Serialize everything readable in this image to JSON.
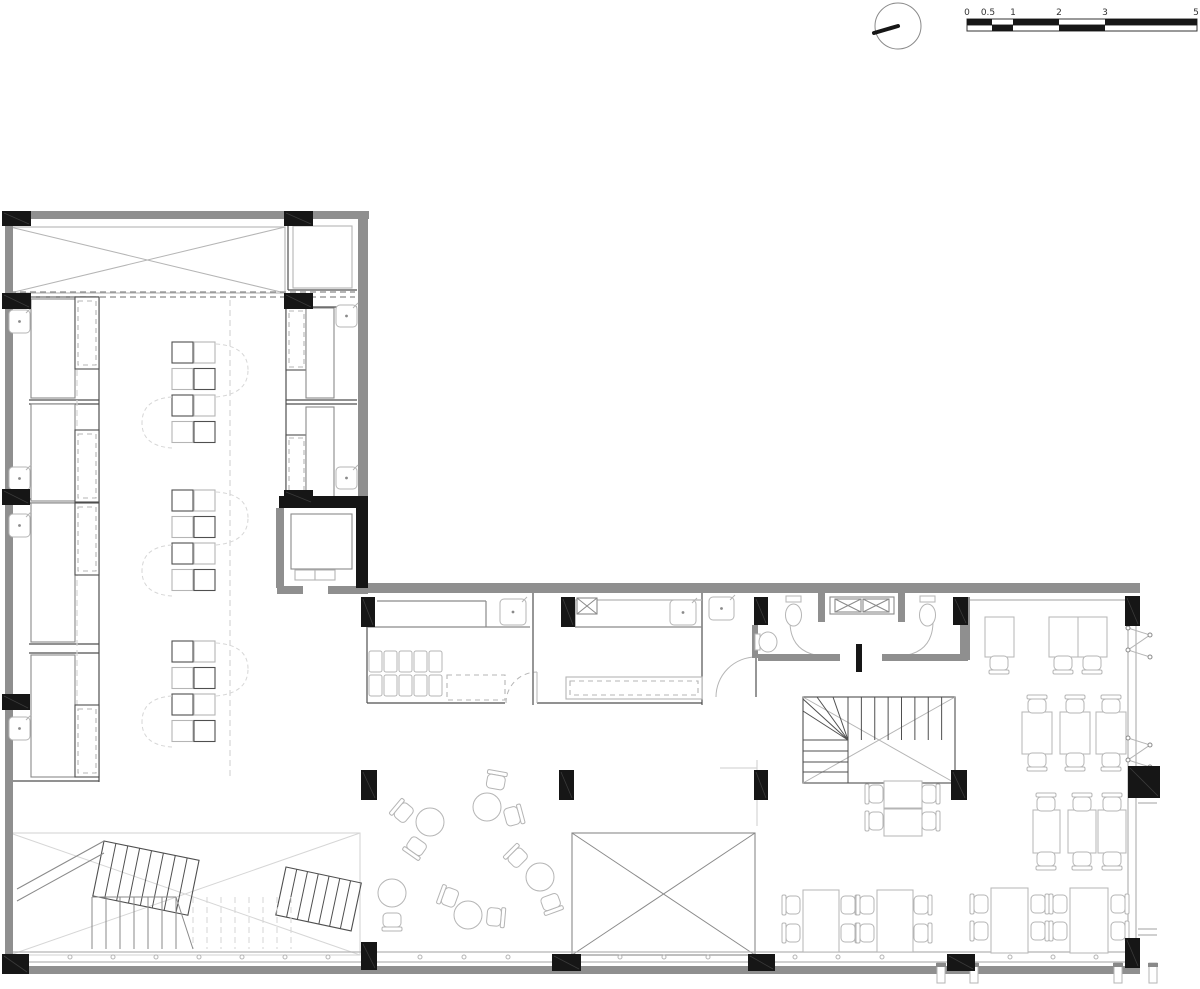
{
  "meta": {
    "width": 1200,
    "height": 989,
    "bg": "#ffffff",
    "title": "architectural-floor-plan"
  },
  "palette": {
    "black": "#161616",
    "wall": "#8f8f8f",
    "dark": "#4f4f4f",
    "mid": "#8a8a8a",
    "light": "#b5b5b5",
    "faint": "#d6d6d6",
    "text": "#333333"
  },
  "north": {
    "cx": 898,
    "cy": 26,
    "r": 23,
    "nx": 874,
    "ny": 33
  },
  "scale_bar": {
    "x": 967,
    "y": 19,
    "h": 12,
    "x_end": 1197,
    "labels": [
      [
        "0",
        967
      ],
      [
        "0.5",
        988
      ],
      [
        "1",
        1013
      ],
      [
        "2",
        1059
      ],
      [
        "3",
        1105
      ],
      [
        "5",
        1196
      ]
    ],
    "top_segments": [
      [
        967,
        25
      ],
      [
        1013,
        46
      ],
      [
        1105,
        92
      ]
    ],
    "bottom_segments": [
      [
        992,
        21
      ],
      [
        1059,
        46
      ]
    ]
  },
  "layers": {
    "xrects": [
      [
        10,
        227,
        275,
        66,
        "light"
      ],
      [
        10,
        833,
        350,
        122,
        "faint"
      ],
      [
        572,
        833,
        183,
        122,
        "mid"
      ]
    ],
    "gray_walls": [
      [
        5,
        211,
        364,
        8
      ],
      [
        5,
        211,
        8,
        756
      ],
      [
        358,
        211,
        10,
        292
      ],
      [
        366,
        583,
        774,
        10
      ],
      [
        276,
        508,
        8,
        80
      ],
      [
        277,
        586,
        26,
        8
      ],
      [
        328,
        586,
        40,
        8
      ],
      [
        758,
        654,
        82,
        7
      ],
      [
        882,
        654,
        86,
        7
      ],
      [
        818,
        592,
        7,
        30
      ],
      [
        898,
        592,
        7,
        30
      ],
      [
        752,
        625,
        6,
        33
      ],
      [
        960,
        597,
        10,
        63
      ],
      [
        5,
        966,
        1135,
        8
      ]
    ],
    "black_walls": [
      [
        279,
        496,
        89,
        12
      ],
      [
        356,
        503,
        12,
        85
      ],
      [
        856,
        644,
        6,
        28
      ]
    ],
    "columns": [
      [
        2,
        211,
        29,
        15
      ],
      [
        284,
        211,
        29,
        15
      ],
      [
        2,
        293,
        29,
        16
      ],
      [
        284,
        293,
        29,
        16
      ],
      [
        2,
        489,
        28,
        16
      ],
      [
        284,
        490,
        29,
        14
      ],
      [
        2,
        694,
        28,
        16
      ],
      [
        361,
        597,
        14,
        30
      ],
      [
        561,
        597,
        14,
        30
      ],
      [
        754,
        597,
        14,
        28
      ],
      [
        953,
        597,
        15,
        28
      ],
      [
        1125,
        596,
        15,
        30
      ],
      [
        361,
        770,
        16,
        30
      ],
      [
        559,
        770,
        15,
        30
      ],
      [
        754,
        770,
        14,
        30
      ],
      [
        951,
        770,
        16,
        30
      ],
      [
        1128,
        766,
        32,
        32
      ],
      [
        2,
        954,
        27,
        20
      ],
      [
        361,
        942,
        16,
        28
      ],
      [
        552,
        954,
        29,
        17
      ],
      [
        748,
        954,
        27,
        17
      ],
      [
        947,
        954,
        28,
        17
      ],
      [
        1125,
        938,
        15,
        30
      ]
    ],
    "lines": [
      [
        99,
        297,
        99,
        782,
        "dark",
        0
      ],
      [
        31,
        297,
        99,
        297,
        "dark",
        0
      ],
      [
        29,
        400,
        99,
        400,
        "dark",
        0
      ],
      [
        29,
        404,
        99,
        404,
        "dark",
        0
      ],
      [
        29,
        499,
        99,
        499,
        "dark",
        0
      ],
      [
        29,
        503,
        99,
        503,
        "dark",
        0
      ],
      [
        29,
        644,
        99,
        644,
        "dark",
        0
      ],
      [
        29,
        653,
        99,
        653,
        "dark",
        0
      ],
      [
        10,
        781,
        99,
        781,
        "dark",
        0
      ],
      [
        286,
        307,
        286,
        497,
        "dark",
        0
      ],
      [
        313,
        307,
        357,
        307,
        "dark",
        0
      ],
      [
        286,
        400,
        357,
        400,
        "dark",
        0
      ],
      [
        286,
        404,
        357,
        404,
        "dark",
        0
      ],
      [
        286,
        497,
        357,
        497,
        "dark",
        0
      ],
      [
        288,
        219,
        288,
        290,
        "dark",
        0
      ],
      [
        288,
        290,
        357,
        290,
        "dark",
        0
      ],
      [
        367,
        627,
        367,
        703,
        "dark",
        0
      ],
      [
        367,
        703,
        505,
        703,
        "dark",
        0
      ],
      [
        533,
        593,
        533,
        705,
        "dark",
        0
      ],
      [
        537,
        703,
        702,
        703,
        "dark",
        0
      ],
      [
        702,
        593,
        702,
        705,
        "dark",
        0
      ],
      [
        377,
        601,
        486,
        601,
        "mid",
        0
      ],
      [
        486,
        601,
        486,
        627,
        "mid",
        0
      ],
      [
        367,
        627,
        530,
        627,
        "mid",
        0
      ],
      [
        575,
        600,
        575,
        627,
        "mid",
        0
      ],
      [
        575,
        627,
        702,
        627,
        "mid",
        0
      ],
      [
        575,
        600,
        702,
        600,
        "light",
        0
      ],
      [
        756,
        625,
        756,
        657,
        "dark",
        0
      ],
      [
        756,
        657,
        756,
        697,
        "dark",
        0
      ],
      [
        970,
        600,
        1128,
        600,
        "light",
        0
      ],
      [
        1128,
        625,
        1128,
        938,
        "light",
        0
      ],
      [
        1136,
        625,
        1136,
        938,
        "light",
        0
      ],
      [
        10,
        952,
        1138,
        952,
        "light",
        0
      ],
      [
        10,
        962,
        1138,
        962,
        "light",
        0
      ],
      [
        1138,
        797,
        1157,
        797,
        "light",
        0
      ],
      [
        1138,
        803,
        1157,
        803,
        "light",
        0
      ],
      [
        1138,
        929,
        1157,
        929,
        "light",
        0
      ],
      [
        1138,
        935,
        1157,
        935,
        "light",
        0
      ],
      [
        720,
        768,
        757,
        768,
        "faint",
        0
      ],
      [
        757,
        760,
        757,
        826,
        "faint",
        0
      ],
      [
        10,
        292,
        355,
        292,
        "mid",
        1
      ],
      [
        10,
        297,
        355,
        297,
        "mid",
        1
      ],
      [
        77,
        300,
        77,
        780,
        "faint",
        1
      ],
      [
        230,
        300,
        230,
        780,
        "faint",
        1
      ]
    ],
    "rects": [
      [
        31,
        299,
        44,
        99,
        "mid",
        0
      ],
      [
        31,
        404,
        44,
        97,
        "mid",
        0
      ],
      [
        31,
        503,
        44,
        139,
        "mid",
        0
      ],
      [
        31,
        655,
        44,
        122,
        "mid",
        0
      ],
      [
        75,
        297,
        24,
        72,
        "dark",
        0
      ],
      [
        75,
        430,
        24,
        72,
        "dark",
        0
      ],
      [
        75,
        503,
        24,
        72,
        "dark",
        0
      ],
      [
        75,
        705,
        24,
        72,
        "dark",
        0
      ],
      [
        78,
        301,
        18,
        64,
        "light",
        1
      ],
      [
        78,
        434,
        18,
        64,
        "light",
        1
      ],
      [
        78,
        507,
        18,
        64,
        "light",
        1
      ],
      [
        78,
        709,
        18,
        64,
        "light",
        1
      ],
      [
        286,
        308,
        20,
        62,
        "dark",
        0
      ],
      [
        286,
        435,
        20,
        62,
        "dark",
        0
      ],
      [
        289,
        311,
        15,
        56,
        "light",
        1
      ],
      [
        289,
        438,
        15,
        56,
        "light",
        1
      ],
      [
        306,
        308,
        28,
        90,
        "mid",
        0
      ],
      [
        306,
        407,
        28,
        90,
        "mid",
        0
      ],
      [
        293,
        226,
        59,
        62,
        "light",
        0
      ],
      [
        291,
        514,
        61,
        55,
        "mid",
        0
      ],
      [
        295,
        570,
        20,
        10,
        "light",
        0
      ],
      [
        315,
        570,
        20,
        10,
        "light",
        0
      ],
      [
        830,
        597,
        64,
        17,
        "mid",
        0
      ],
      [
        566,
        677,
        136,
        22,
        "light",
        0
      ],
      [
        570,
        681,
        128,
        14,
        "light",
        1
      ],
      [
        447,
        675,
        58,
        25,
        "light",
        1
      ]
    ],
    "xboxes": [
      [
        577,
        598,
        20,
        16
      ],
      [
        835,
        599,
        26,
        13
      ],
      [
        863,
        599,
        26,
        13
      ]
    ],
    "appliances": {
      "x": 369,
      "rows": [
        651,
        675
      ],
      "cols": 5,
      "dx": 15,
      "w": 13,
      "h": 21
    },
    "sinks": [
      [
        9,
        310,
        21,
        23
      ],
      [
        9,
        467,
        21,
        23
      ],
      [
        9,
        514,
        21,
        23
      ],
      [
        9,
        717,
        21,
        23
      ],
      [
        336,
        305,
        21,
        22
      ],
      [
        336,
        467,
        21,
        22
      ],
      [
        709,
        597,
        25,
        23
      ],
      [
        500,
        599,
        26,
        26
      ],
      [
        670,
        600,
        26,
        25
      ]
    ],
    "toilets": [
      [
        786,
        596
      ],
      [
        920,
        596
      ]
    ],
    "urinal": [
      757,
      632
    ],
    "paths": [
      [
        "M 506,703 A 31 31 0 0 1 537,672",
        "light",
        1
      ],
      [
        "M 537,672 L 537,703",
        "light",
        0
      ],
      [
        "M 716,697 A 40 40 0 0 1 756,657",
        "light",
        0
      ],
      [
        "M 790,623 Q 791,653 822,656",
        "light",
        0
      ],
      [
        "M 933,623 Q 932,653 901,656",
        "light",
        0
      ]
    ],
    "clusters": [
      [
        172,
        342
      ],
      [
        172,
        490
      ],
      [
        172,
        641
      ]
    ],
    "round_tables": [
      [
        430,
        822
      ],
      [
        487,
        807
      ],
      [
        540,
        877
      ],
      [
        392,
        893
      ],
      [
        468,
        915
      ]
    ],
    "tables": [
      [
        985,
        617,
        29,
        40
      ],
      [
        1049,
        617,
        29,
        40
      ],
      [
        1078,
        617,
        29,
        40
      ],
      [
        1022,
        712,
        30,
        42
      ],
      [
        1060,
        712,
        30,
        42
      ],
      [
        1096,
        712,
        30,
        42
      ],
      [
        1033,
        810,
        27,
        43
      ],
      [
        1068,
        810,
        28,
        43
      ],
      [
        1098,
        810,
        28,
        43
      ],
      [
        803,
        890,
        36,
        62
      ],
      [
        877,
        890,
        36,
        62
      ],
      [
        991,
        888,
        37,
        65
      ],
      [
        1070,
        888,
        38,
        65
      ],
      [
        884,
        781,
        38,
        27
      ],
      [
        884,
        809,
        38,
        27
      ]
    ],
    "chairs": [
      [
        999,
        664,
        180
      ],
      [
        1063,
        664,
        180
      ],
      [
        1092,
        664,
        180
      ],
      [
        1037,
        705,
        0
      ],
      [
        1075,
        705,
        0
      ],
      [
        1111,
        705,
        0
      ],
      [
        1037,
        761,
        180
      ],
      [
        1075,
        761,
        180
      ],
      [
        1111,
        761,
        180
      ],
      [
        1046,
        803,
        0
      ],
      [
        1082,
        803,
        0
      ],
      [
        1112,
        803,
        0
      ],
      [
        1046,
        860,
        180
      ],
      [
        1082,
        860,
        180
      ],
      [
        1112,
        860,
        180
      ],
      [
        792,
        905,
        -90
      ],
      [
        792,
        933,
        -90
      ],
      [
        849,
        905,
        90
      ],
      [
        849,
        933,
        90
      ],
      [
        866,
        905,
        -90
      ],
      [
        866,
        933,
        -90
      ],
      [
        922,
        905,
        90
      ],
      [
        922,
        933,
        90
      ],
      [
        980,
        904,
        -90
      ],
      [
        980,
        931,
        -90
      ],
      [
        1039,
        904,
        90
      ],
      [
        1039,
        931,
        90
      ],
      [
        1059,
        904,
        -90
      ],
      [
        1059,
        931,
        -90
      ],
      [
        1119,
        904,
        90
      ],
      [
        1119,
        931,
        90
      ],
      [
        875,
        794,
        -90
      ],
      [
        875,
        821,
        -90
      ],
      [
        930,
        794,
        90
      ],
      [
        930,
        821,
        90
      ],
      [
        403,
        812,
        -50
      ],
      [
        416,
        847,
        215
      ],
      [
        496,
        781,
        10
      ],
      [
        513,
        816,
        75
      ],
      [
        517,
        857,
        -45
      ],
      [
        551,
        903,
        160
      ],
      [
        392,
        921,
        180
      ],
      [
        449,
        897,
        -70
      ],
      [
        495,
        917,
        95
      ]
    ],
    "ticks": {
      "y": 957,
      "xs": [
        70,
        113,
        156,
        199,
        242,
        285,
        328,
        420,
        464,
        508,
        620,
        664,
        708,
        795,
        838,
        882,
        1010,
        1053,
        1096
      ]
    },
    "posts": [
      [
        937,
        963
      ],
      [
        970,
        963
      ],
      [
        1114,
        963
      ],
      [
        1149,
        963
      ]
    ],
    "zigzags": [
      [
        1128,
        628
      ],
      [
        1128,
        738
      ]
    ],
    "stair_main": {
      "x": 803,
      "y": 697,
      "w": 152,
      "h": 86,
      "split": 45,
      "topH": 43,
      "nv": 8,
      "hy": [
        740,
        751,
        762,
        772
      ]
    },
    "stair_feature": {
      "fa": {
        "x": 104,
        "y": 841,
        "rot": 11.5,
        "w": 97,
        "h": 56,
        "n": 8
      },
      "fb": {
        "x": 286,
        "y": 867,
        "rot": 12,
        "w": 77,
        "h": 49,
        "n": 7
      },
      "straight": {
        "x": 92,
        "y": 897,
        "w": 84,
        "h": 52,
        "n": 6
      },
      "dashed": {
        "x": 193,
        "y": 897,
        "w": 98,
        "h": 52,
        "n": 7
      },
      "diag": [
        [
          176,
          897,
          193,
          949
        ],
        [
          17,
          889,
          104,
          841
        ],
        [
          17,
          901,
          104,
          853
        ]
      ]
    }
  }
}
